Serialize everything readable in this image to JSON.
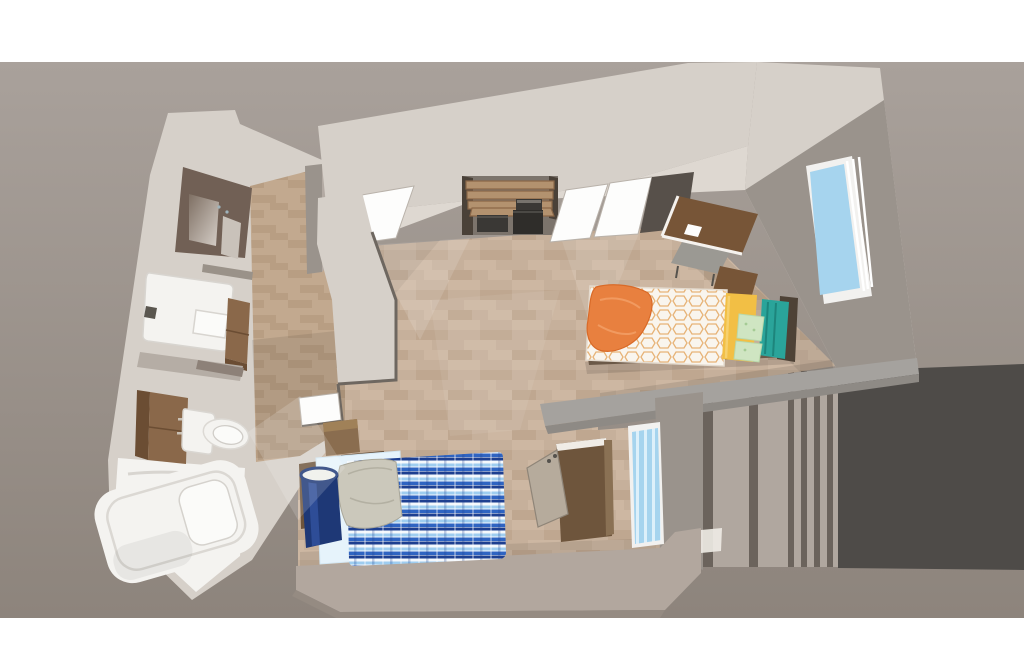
{
  "meta": {
    "render_type": "3d-floorplan-isometric-render",
    "description": "Top-down 3D cutaway rendering of a studio apartment unit with en-suite bathroom, kitchenette alcove, two twin beds, desks and windows"
  },
  "palette": {
    "pageBg": "#ffffff",
    "bgTop": "#a9a19b",
    "bgBottom": "#8d847c",
    "outsideDark": "#4e4b48",
    "slatLight": "#b0a79f",
    "slatDark": "#6b635c",
    "wallTop": "#d6d0c9",
    "wallInner": "#ded8d1",
    "wallFace": "#9a938c",
    "wallMid": "#b3aaa3",
    "wallSeam": "#6e6760",
    "halfWallTop": "#a5a29e",
    "halfWallLip": "#8e8a85",
    "bottomWallTop": "#b2a79e",
    "bottomWallEdge": "#958b82",
    "doorWhite": "#fdfdfc",
    "doorEdge": "#b9b2aa",
    "floorBase": "#c6b09b",
    "floorAltLight": "#cdb7a2",
    "floorAltDark": "#bfa790",
    "bathFloorBase": "#c2a98f",
    "bathFloorAlt": "#b89e83",
    "mirrorFrame": "#716055",
    "mirrorGlassDark": "#7e6f63",
    "mirrorGlassLight": "#d6cfc8",
    "sideCabinet": "#c9c2ba",
    "fixtureWhite": "#f4f3f0",
    "fixtureBright": "#fbfbf9",
    "fixtureShade": "#d8d5d0",
    "faucetDark": "#5a564f",
    "woodMain": "#8a684a",
    "woodDark": "#6b4d33",
    "woodHandle": "#c9c0b4",
    "ledgeGray": "#9a9289",
    "midBand": "#b5ada5",
    "ledgeDark": "#8d8178",
    "shelfWood": "#b3926f",
    "shelfEdge": "#8a6748",
    "alcoveBack": "#7c746c",
    "alcovePost": "#4a4138",
    "applianceDark": "#3a3835",
    "applianceDarker": "#2f2d2a",
    "applianceLight": "#77736d",
    "recessDark": "#57504a",
    "deskBrown": "#775537",
    "deskDark": "#5e3f26",
    "deskEdgeWhite": "#f5f2ee",
    "chairGray": "#9b9993",
    "chairLeg": "#55524d",
    "windowFrame": "#f2f1ef",
    "windowGlass": "#a6d4ee",
    "windowGlassStripe": "#ddf0fa",
    "comforterBase": "#f9f5ee",
    "comforterPattern": "#e7b377",
    "orangeBlanket": "#e8803f",
    "orangeBlanketDark": "#d96a28",
    "orangeBlanketLight": "#f19a60",
    "yellowPillow": "#f2bf45",
    "yellowPillowLight": "#f6d06e",
    "greenPillow": "#cfe5c2",
    "greenPillowDot": "#a5cb95",
    "tealBlanket": "#2aa49a",
    "tealBlanketDark": "#1d857c",
    "headboardDark": "#4e4236",
    "bedFrameDark": "#6b5948",
    "bed2Sheet": "#e6f3fb",
    "plaidWhite": "#f4f8fc",
    "plaidLight": "#9ecdf0",
    "plaidMid": "#2f64c2",
    "plaidNavy": "#1e3f90",
    "grayBlanket": "#cbc8bb",
    "grayBlanketFold": "#b3b0a2",
    "navyRoll": "#1e3876",
    "navyRollLight": "#31519e",
    "rollCapWhite": "#eff0ea",
    "wardrobeBrown": "#6e553c",
    "wardrobeEdge": "#f0ece6",
    "leaningBoard": "#b6ab9c",
    "leaningBoardEdge": "#8f8578",
    "boxWood": "#8a6d4f",
    "boxWoodTop": "#a08158",
    "shelfDark": "#5f4a36",
    "shadow": "#000000",
    "sheen": "#ffffff"
  },
  "scene": {
    "outside": [
      "backdrop-ground",
      "dark-stair-void",
      "railing-slats"
    ],
    "rooms": [
      {
        "id": "bathroom",
        "fixtures": [
          "vanity-mirror",
          "side-cabinet",
          "sink",
          "under-sink-cabinet",
          "wall-cabinet",
          "toilet",
          "shower-rod",
          "bathtub",
          "bathroom-door"
        ]
      },
      {
        "id": "main-room",
        "fixtures": [
          "kitchenette-alcove",
          "shelves",
          "microwave",
          "mini-fridge",
          "closet-doors",
          "corner-desk",
          "desk-chair",
          "nightstand",
          "window-right",
          "bed-orange",
          "half-wall",
          "window-bottom",
          "wardrobe",
          "leaning-chair",
          "bed-blue",
          "navy-roll",
          "storage-box",
          "bottom-wall"
        ]
      }
    ]
  }
}
